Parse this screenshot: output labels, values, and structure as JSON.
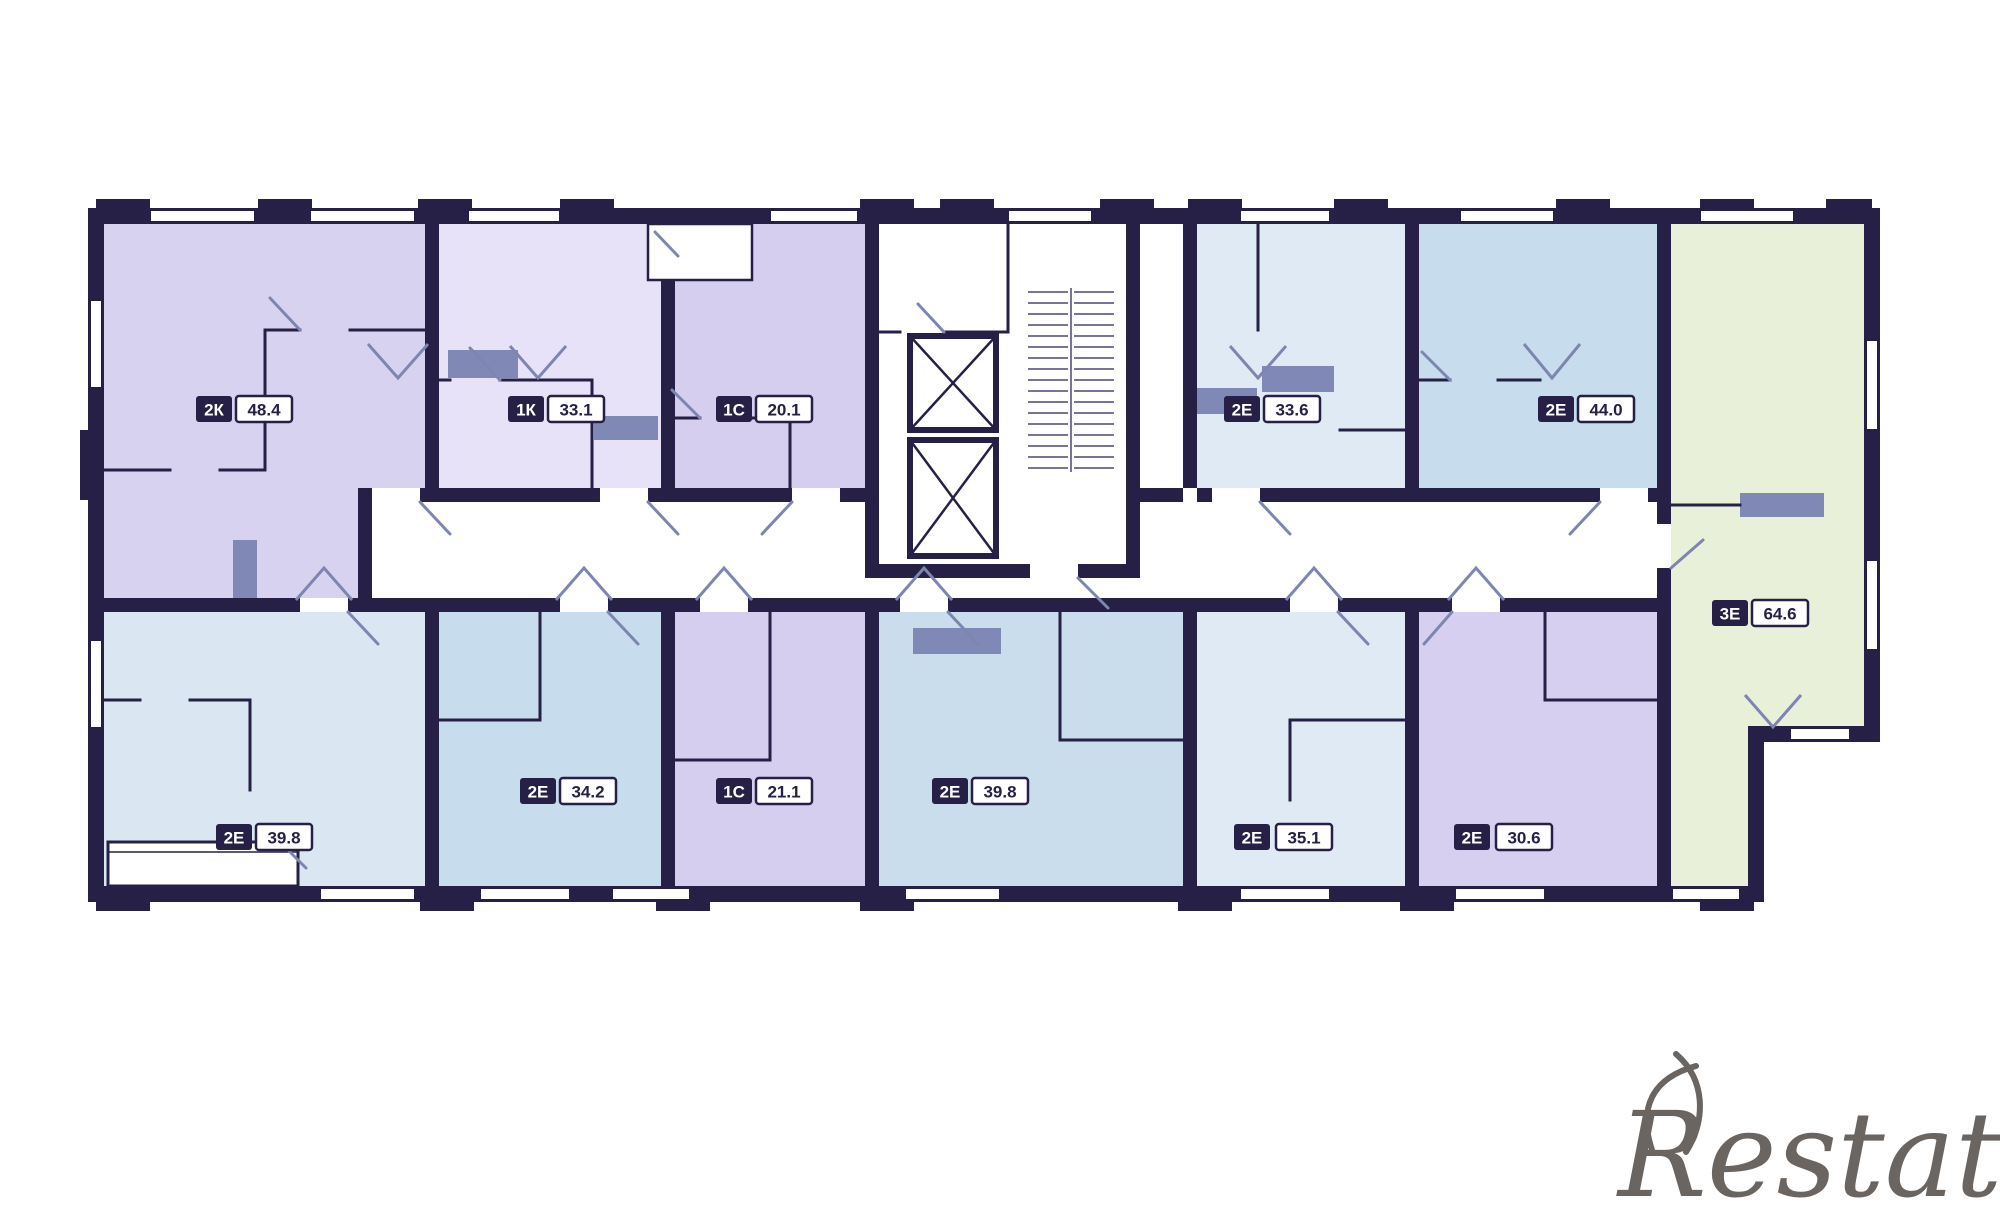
{
  "watermark": {
    "text": "Restate",
    "color": "#56504c"
  },
  "plan": {
    "wall_color": "#262047",
    "door_color": "#7d85b0",
    "shaft_color": "#8089b6",
    "apartments": [
      {
        "type": "2К",
        "area": "48.4",
        "color": "#d8d2f1",
        "position": "top-left"
      },
      {
        "type": "1К",
        "area": "33.1",
        "color": "#e7e2f7",
        "position": "top-2"
      },
      {
        "type": "1С",
        "area": "20.1",
        "color": "#d5ceee",
        "position": "top-3"
      },
      {
        "type": "2Е",
        "area": "33.6",
        "color": "#dfeaf5",
        "position": "top-4"
      },
      {
        "type": "2Е",
        "area": "44.0",
        "color": "#c7dcec",
        "position": "top-5"
      },
      {
        "type": "3Е",
        "area": "64.6",
        "color": "#e9f0da",
        "position": "right"
      },
      {
        "type": "2Е",
        "area": "39.8",
        "color": "#dae7f3",
        "position": "bottom-left"
      },
      {
        "type": "2Е",
        "area": "34.2",
        "color": "#c7dcec",
        "position": "bottom-2"
      },
      {
        "type": "1С",
        "area": "21.1",
        "color": "#d5ceee",
        "position": "bottom-3"
      },
      {
        "type": "2Е",
        "area": "39.8",
        "color": "#cadded",
        "position": "bottom-4"
      },
      {
        "type": "2Е",
        "area": "35.1",
        "color": "#dfeaf5",
        "position": "bottom-5"
      },
      {
        "type": "2Е",
        "area": "30.6",
        "color": "#d7cff0",
        "position": "bottom-6"
      }
    ]
  }
}
